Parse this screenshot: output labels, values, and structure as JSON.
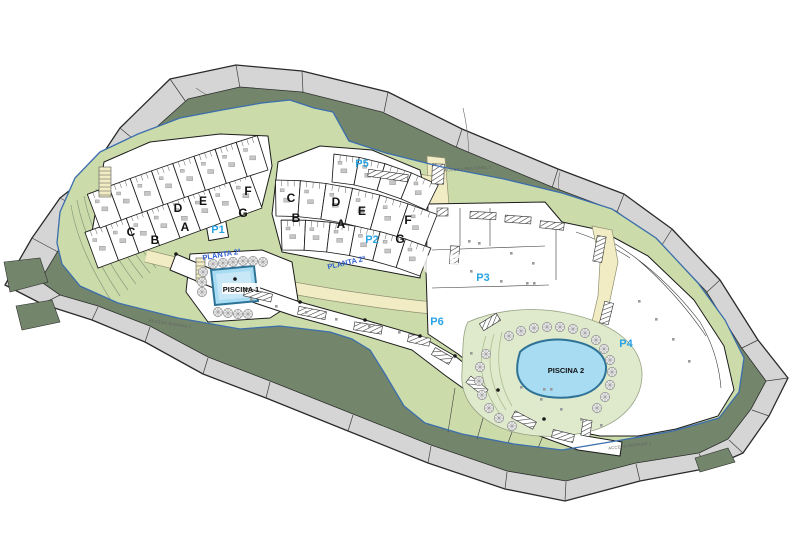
{
  "plan": {
    "title": "residential-site-plan",
    "watermark": "CE",
    "unit_labels": {
      "a": "A",
      "b": "B",
      "c": "C",
      "d": "D",
      "e": "E",
      "f": "F",
      "g": "G"
    },
    "parking": {
      "p1": "P1",
      "p2": "P2",
      "p3": "P3",
      "p4": "P4",
      "p5": "P5",
      "p6": "P6"
    },
    "level_label": "PLANTA 2ª",
    "pools": {
      "pool1": "PISCINA 1",
      "pool2": "PISCINA 2"
    },
    "access": {
      "pedestrian1": "ACCESO PEATONAL 1",
      "road1": "ACCESO RODADO 1",
      "road2": "ACCESO RODADO 2"
    },
    "colors": {
      "outer_band": "#d5d5d5",
      "dark_green": "#73866b",
      "light_green": "#cbdcaa",
      "terrace_green": "#dfe9cb",
      "path_cream": "#f1ecc3",
      "pool_blue": "#a8dcf2",
      "boundary_blue": "#3d6fae",
      "parking_blue": "#29a3e3",
      "level_blue": "#2f5fd0"
    }
  }
}
